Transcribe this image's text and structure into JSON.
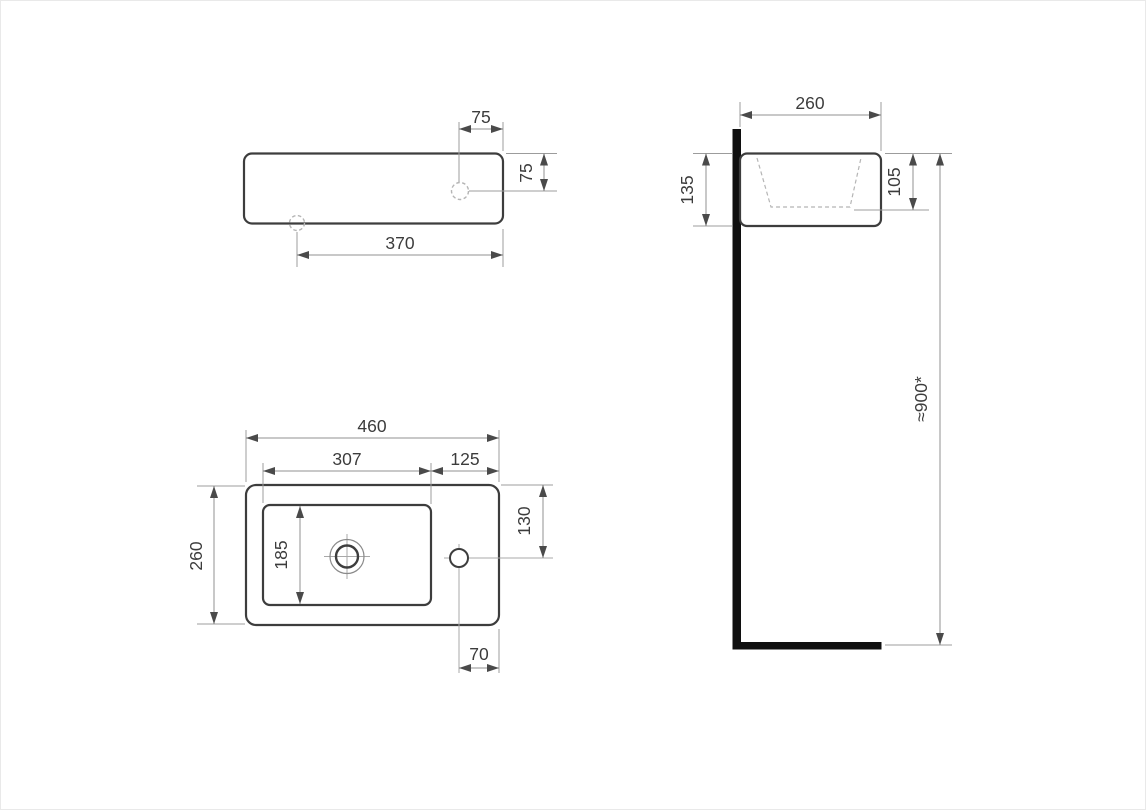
{
  "drawing": {
    "type": "technical-drawing",
    "subject": "wall-mounted washbasin dimensional drawing, three orthographic views",
    "views": {
      "front": {
        "name": "front view",
        "dims": {
          "tap_hole_offset_x": "75",
          "tap_hole_offset_y": "75",
          "drain_to_right_edge": "370"
        }
      },
      "plan": {
        "name": "plan view",
        "dims": {
          "overall_width": "460",
          "bowl_width": "307",
          "right_deck_width": "125",
          "overall_depth": "260",
          "bowl_depth": "185",
          "tap_hole_from_back": "130",
          "tap_hole_from_right": "70"
        }
      },
      "side": {
        "name": "side view",
        "dims": {
          "overall_depth": "260",
          "body_height": "135",
          "inner_depth": "105",
          "mount_height": "≈900*"
        }
      }
    },
    "colors": {
      "background": "#ffffff",
      "outline": "#3d3d3d",
      "dimension_line": "#909090",
      "hidden_line": "#b5b5b5",
      "wall": "#101010",
      "text": "#3c3c3c"
    }
  }
}
